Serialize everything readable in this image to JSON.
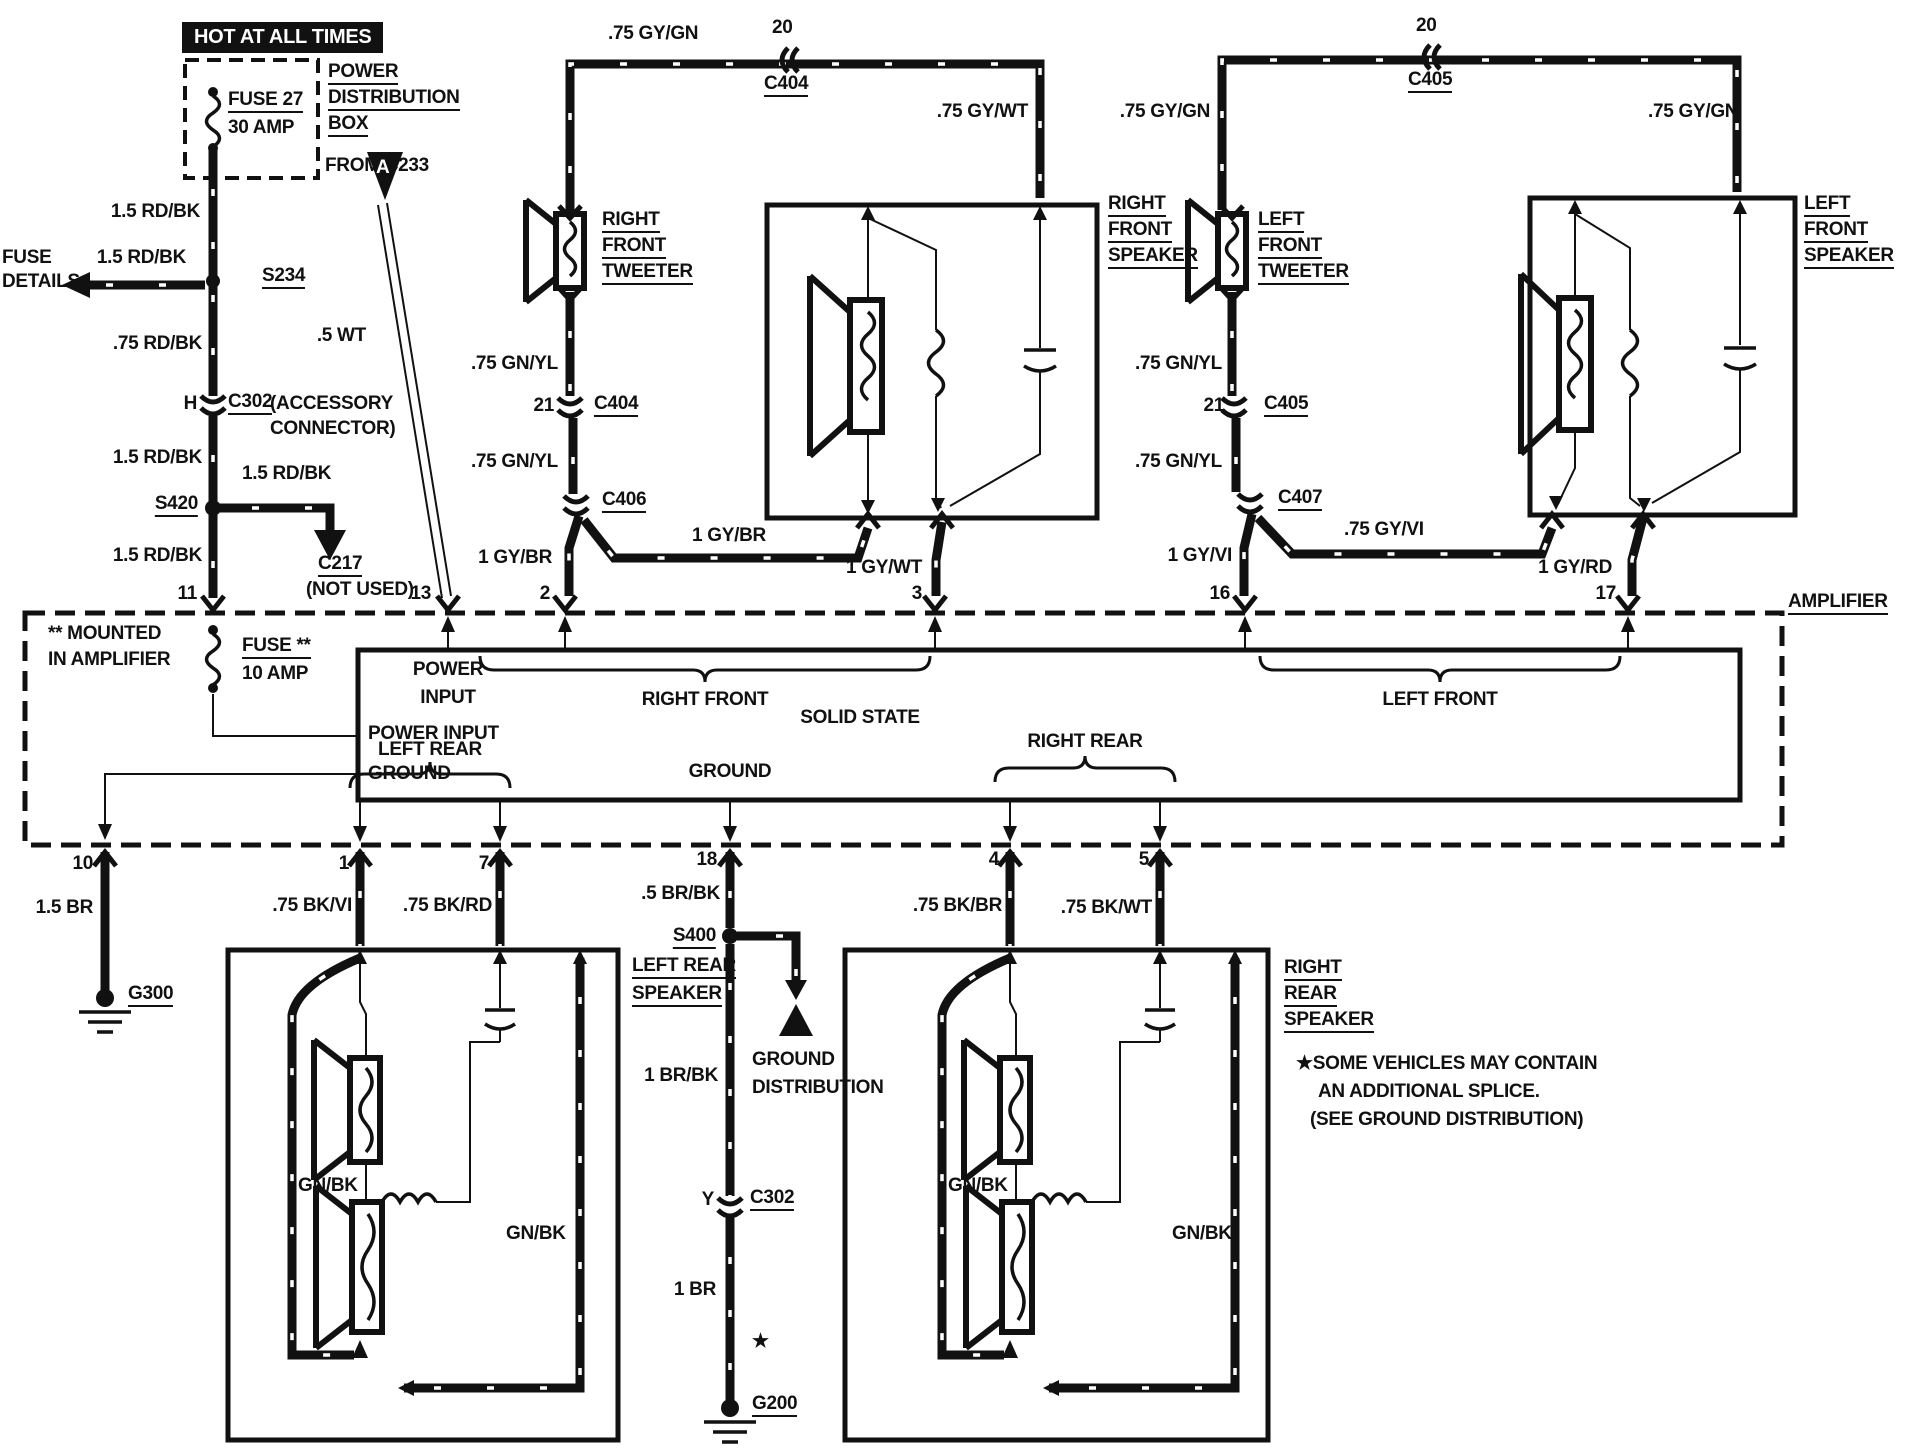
{
  "diagram": {
    "kind": "automotive audio system wiring diagram",
    "main_block": "AMPLIFIER (SOLID STATE)",
    "ink_color": "#111111",
    "paper_color": "#ffffff"
  },
  "components": [
    {
      "id": "FUSE 27",
      "rating": "30 AMP",
      "location": "POWER DISTRIBUTION BOX"
    },
    {
      "id": "FUSE **",
      "rating": "10 AMP",
      "location": "MOUNTED IN AMPLIFIER"
    },
    {
      "id": "AMPLIFIER",
      "note": "SOLID STATE"
    },
    {
      "id": "RIGHT FRONT TWEETER"
    },
    {
      "id": "RIGHT FRONT SPEAKER"
    },
    {
      "id": "LEFT FRONT TWEETER"
    },
    {
      "id": "LEFT FRONT SPEAKER"
    },
    {
      "id": "LEFT REAR SPEAKER"
    },
    {
      "id": "RIGHT REAR SPEAKER"
    },
    {
      "id": "S234"
    },
    {
      "id": "S420"
    },
    {
      "id": "S400"
    },
    {
      "id": "G200"
    },
    {
      "id": "G300"
    },
    {
      "id": "C217",
      "note": "NOT USED"
    },
    {
      "id": "C302",
      "note": "ACCESSORY CONNECTOR"
    },
    {
      "id": "C404"
    },
    {
      "id": "C405"
    },
    {
      "id": "C406"
    },
    {
      "id": "C407"
    }
  ],
  "labels": [
    {
      "name": "hot-at-all-times",
      "text": "HOT AT ALL TIMES",
      "x": 182,
      "y": 22,
      "inv": true
    },
    {
      "name": "fuse27",
      "text": "FUSE 27",
      "x": 228,
      "y": 90,
      "u": true
    },
    {
      "name": "fuse27-rating",
      "text": "30 AMP",
      "x": 228,
      "y": 118
    },
    {
      "name": "power-dist-1",
      "text": "POWER",
      "x": 328,
      "y": 62,
      "u": true
    },
    {
      "name": "power-dist-2",
      "text": "DISTRIBUTION",
      "x": 328,
      "y": 88,
      "u": true
    },
    {
      "name": "power-dist-3",
      "text": "BOX",
      "x": 328,
      "y": 114,
      "u": true
    },
    {
      "name": "from-c233",
      "text": "FROM C233",
      "x": 325,
      "y": 156
    },
    {
      "name": "wire-15rdbk-1",
      "text": "1.5 RD/BK",
      "x": 200,
      "y": 202,
      "align": "right"
    },
    {
      "name": "fuse-details-1",
      "text": "FUSE",
      "x": 2,
      "y": 248
    },
    {
      "name": "fuse-details-2",
      "text": "DETAILS",
      "x": 2,
      "y": 272
    },
    {
      "name": "wire-15rdbk-2",
      "text": "1.5 RD/BK",
      "x": 186,
      "y": 248,
      "align": "right"
    },
    {
      "name": "splice-s234",
      "text": "S234",
      "x": 262,
      "y": 266,
      "u": true
    },
    {
      "name": "wire-75rdbk",
      "text": ".75 RD/BK",
      "x": 202,
      "y": 334,
      "align": "right"
    },
    {
      "name": "c302-pin-h",
      "text": "H",
      "x": 197,
      "y": 394,
      "align": "right"
    },
    {
      "name": "conn-c302",
      "text": "C302",
      "x": 228,
      "y": 392,
      "u": true
    },
    {
      "name": "accessory-1",
      "text": "(ACCESSORY",
      "x": 270,
      "y": 394
    },
    {
      "name": "accessory-2",
      "text": "CONNECTOR)",
      "x": 270,
      "y": 419
    },
    {
      "name": "wire-15rdbk-3",
      "text": "1.5 RD/BK",
      "x": 202,
      "y": 448,
      "align": "right"
    },
    {
      "name": "splice-s420",
      "text": "S420",
      "x": 198,
      "y": 494,
      "u": true,
      "align": "right"
    },
    {
      "name": "wire-15rdbk-4",
      "text": "1.5 RD/BK",
      "x": 242,
      "y": 464
    },
    {
      "name": "conn-c217",
      "text": "C217",
      "x": 318,
      "y": 554,
      "u": true
    },
    {
      "name": "c217-not-used",
      "text": "(NOT USED)",
      "x": 306,
      "y": 580
    },
    {
      "name": "wire-15rdbk-5",
      "text": "1.5 RD/BK",
      "x": 202,
      "y": 546,
      "align": "right"
    },
    {
      "name": "pin-11",
      "text": "11",
      "x": 197,
      "y": 584,
      "align": "right"
    },
    {
      "name": "wire-5wt",
      "text": ".5 WT",
      "x": 366,
      "y": 326,
      "align": "right"
    },
    {
      "name": "pin-13",
      "text": "13",
      "x": 431,
      "y": 584,
      "align": "right"
    },
    {
      "name": "wire-gygn-1",
      "text": ".75 GY/GN",
      "x": 608,
      "y": 24
    },
    {
      "name": "c404-top-pin",
      "text": "20",
      "x": 772,
      "y": 18
    },
    {
      "name": "conn-c404-top",
      "text": "C404",
      "x": 764,
      "y": 74,
      "u": true
    },
    {
      "name": "wire-gywt-1",
      "text": ".75 GY/WT",
      "x": 1028,
      "y": 102,
      "align": "right"
    },
    {
      "name": "rf-tweeter-1",
      "text": "RIGHT",
      "x": 602,
      "y": 210,
      "u": true
    },
    {
      "name": "rf-tweeter-2",
      "text": "FRONT",
      "x": 602,
      "y": 236,
      "u": true
    },
    {
      "name": "rf-tweeter-3",
      "text": "TWEETER",
      "x": 602,
      "y": 262,
      "u": true
    },
    {
      "name": "wire-gnyl-1",
      "text": ".75 GN/YL",
      "x": 558,
      "y": 354,
      "align": "right"
    },
    {
      "name": "c404-pin-21",
      "text": "21",
      "x": 554,
      "y": 396,
      "align": "right"
    },
    {
      "name": "conn-c404",
      "text": "C404",
      "x": 594,
      "y": 394,
      "u": true
    },
    {
      "name": "wire-gnyl-2",
      "text": ".75 GN/YL",
      "x": 558,
      "y": 452,
      "align": "right"
    },
    {
      "name": "conn-c406",
      "text": "C406",
      "x": 602,
      "y": 490,
      "u": true
    },
    {
      "name": "wire-gybr-1",
      "text": "1 GY/BR",
      "x": 552,
      "y": 548,
      "align": "right"
    },
    {
      "name": "wire-gybr-2",
      "text": "1 GY/BR",
      "x": 692,
      "y": 526
    },
    {
      "name": "pin-2",
      "text": "2",
      "x": 550,
      "y": 584,
      "align": "right"
    },
    {
      "name": "wire-gywt-2",
      "text": "1 GY/WT",
      "x": 922,
      "y": 558,
      "align": "right"
    },
    {
      "name": "pin-3",
      "text": "3",
      "x": 922,
      "y": 584,
      "align": "right"
    },
    {
      "name": "rf-speaker-1",
      "text": "RIGHT",
      "x": 1108,
      "y": 194,
      "u": true
    },
    {
      "name": "rf-speaker-2",
      "text": "FRONT",
      "x": 1108,
      "y": 220,
      "u": true
    },
    {
      "name": "rf-speaker-3",
      "text": "SPEAKER",
      "x": 1108,
      "y": 246,
      "u": true
    },
    {
      "name": "wire-gygn-2",
      "text": ".75 GY/GN",
      "x": 1210,
      "y": 102,
      "align": "right"
    },
    {
      "name": "c405-top-pin",
      "text": "20",
      "x": 1416,
      "y": 16
    },
    {
      "name": "conn-c405-top",
      "text": "C405",
      "x": 1408,
      "y": 70,
      "u": true
    },
    {
      "name": "wire-gygn-3",
      "text": ".75 GY/GN",
      "x": 1648,
      "y": 102
    },
    {
      "name": "lf-tweeter-1",
      "text": "LEFT",
      "x": 1258,
      "y": 210,
      "u": true
    },
    {
      "name": "lf-tweeter-2",
      "text": "FRONT",
      "x": 1258,
      "y": 236,
      "u": true
    },
    {
      "name": "lf-tweeter-3",
      "text": "TWEETER",
      "x": 1258,
      "y": 262,
      "u": true
    },
    {
      "name": "wire-gnyl-3",
      "text": ".75 GN/YL",
      "x": 1222,
      "y": 354,
      "align": "right"
    },
    {
      "name": "c405-pin-21",
      "text": "21",
      "x": 1224,
      "y": 396,
      "align": "right"
    },
    {
      "name": "conn-c405",
      "text": "C405",
      "x": 1264,
      "y": 394,
      "u": true
    },
    {
      "name": "wire-gnyl-4",
      "text": ".75 GN/YL",
      "x": 1222,
      "y": 452,
      "align": "right"
    },
    {
      "name": "conn-c407",
      "text": "C407",
      "x": 1278,
      "y": 488,
      "u": true
    },
    {
      "name": "wire-gyvi-1",
      "text": "1 GY/VI",
      "x": 1232,
      "y": 546,
      "align": "right"
    },
    {
      "name": "wire-gyvi-2",
      "text": ".75 GY/VI",
      "x": 1344,
      "y": 520
    },
    {
      "name": "pin-16",
      "text": "16",
      "x": 1230,
      "y": 584,
      "align": "right"
    },
    {
      "name": "wire-gyrd",
      "text": "1 GY/RD",
      "x": 1612,
      "y": 558,
      "align": "right"
    },
    {
      "name": "pin-17",
      "text": "17",
      "x": 1616,
      "y": 584,
      "align": "right"
    },
    {
      "name": "lf-speaker-1",
      "text": "LEFT",
      "x": 1804,
      "y": 194,
      "u": true
    },
    {
      "name": "lf-speaker-2",
      "text": "FRONT",
      "x": 1804,
      "y": 220,
      "u": true
    },
    {
      "name": "lf-speaker-3",
      "text": "SPEAKER",
      "x": 1804,
      "y": 246,
      "u": true
    },
    {
      "name": "amplifier",
      "text": "AMPLIFIER",
      "x": 1788,
      "y": 592,
      "u": true
    },
    {
      "name": "mounted-1",
      "text": "** MOUNTED",
      "x": 48,
      "y": 624
    },
    {
      "name": "mounted-2",
      "text": "IN AMPLIFIER",
      "x": 48,
      "y": 650
    },
    {
      "name": "fuse-amp",
      "text": "FUSE **",
      "x": 242,
      "y": 636,
      "u": true
    },
    {
      "name": "fuse-amp-rating",
      "text": "10 AMP",
      "x": 242,
      "y": 664
    },
    {
      "name": "power-input13-1",
      "text": "POWER",
      "x": 448,
      "y": 660,
      "align": "center"
    },
    {
      "name": "power-input13-2",
      "text": "INPUT",
      "x": 448,
      "y": 688,
      "align": "center"
    },
    {
      "name": "brace-right-front",
      "text": "RIGHT FRONT",
      "x": 705,
      "y": 690,
      "align": "center"
    },
    {
      "name": "solid-state",
      "text": "SOLID STATE",
      "x": 860,
      "y": 708,
      "align": "center"
    },
    {
      "name": "brace-left-front",
      "text": "LEFT FRONT",
      "x": 1440,
      "y": 690,
      "align": "center"
    },
    {
      "name": "power-input-left",
      "text": "POWER INPUT",
      "x": 368,
      "y": 724
    },
    {
      "name": "ground-left",
      "text": "GROUND",
      "x": 368,
      "y": 764
    },
    {
      "name": "brace-left-rear",
      "text": "LEFT REAR",
      "x": 430,
      "y": 740,
      "align": "center"
    },
    {
      "name": "ground-center",
      "text": "GROUND",
      "x": 730,
      "y": 762,
      "align": "center"
    },
    {
      "name": "brace-right-rear",
      "text": "RIGHT REAR",
      "x": 1085,
      "y": 732,
      "align": "center"
    },
    {
      "name": "pin-10",
      "text": "10",
      "x": 93,
      "y": 854,
      "align": "right"
    },
    {
      "name": "wire-15br",
      "text": "1.5 BR",
      "x": 93,
      "y": 898,
      "align": "right"
    },
    {
      "name": "ground-g300",
      "text": "G300",
      "x": 128,
      "y": 984,
      "u": true
    },
    {
      "name": "pin-1",
      "text": "1",
      "x": 349,
      "y": 854,
      "align": "right"
    },
    {
      "name": "wire-bkvi",
      "text": ".75 BK/VI",
      "x": 352,
      "y": 896,
      "align": "right"
    },
    {
      "name": "pin-7",
      "text": "7",
      "x": 489,
      "y": 854,
      "align": "right"
    },
    {
      "name": "wire-bkrd",
      "text": ".75 BK/RD",
      "x": 492,
      "y": 896,
      "align": "right"
    },
    {
      "name": "pin-18",
      "text": "18",
      "x": 717,
      "y": 850,
      "align": "right"
    },
    {
      "name": "wire-brbk",
      "text": ".5 BR/BK",
      "x": 720,
      "y": 884,
      "align": "right"
    },
    {
      "name": "splice-s400",
      "text": "S400",
      "x": 716,
      "y": 926,
      "u": true,
      "align": "right"
    },
    {
      "name": "pin-4",
      "text": "4",
      "x": 999,
      "y": 850,
      "align": "right"
    },
    {
      "name": "wire-bkbr",
      "text": ".75 BK/BR",
      "x": 1002,
      "y": 896,
      "align": "right"
    },
    {
      "name": "pin-5",
      "text": "5",
      "x": 1149,
      "y": 850,
      "align": "right"
    },
    {
      "name": "wire-bkwt",
      "text": ".75 BK/WT",
      "x": 1152,
      "y": 898,
      "align": "right"
    },
    {
      "name": "lr-speaker-1",
      "text": "LEFT REAR",
      "x": 632,
      "y": 956,
      "u": true
    },
    {
      "name": "lr-speaker-2",
      "text": "SPEAKER",
      "x": 632,
      "y": 984,
      "u": true
    },
    {
      "name": "ground-dist-1",
      "text": "GROUND",
      "x": 752,
      "y": 1050
    },
    {
      "name": "ground-dist-2",
      "text": "DISTRIBUTION",
      "x": 752,
      "y": 1078
    },
    {
      "name": "wire-brbk-2",
      "text": "1 BR/BK",
      "x": 718,
      "y": 1066,
      "align": "right"
    },
    {
      "name": "c302y-pin",
      "text": "Y",
      "x": 714,
      "y": 1190,
      "align": "right"
    },
    {
      "name": "conn-c302-y",
      "text": "C302",
      "x": 750,
      "y": 1188,
      "u": true
    },
    {
      "name": "wire-1br",
      "text": "1 BR",
      "x": 716,
      "y": 1280,
      "align": "right"
    },
    {
      "name": "splice-star",
      "text": "★",
      "x": 752,
      "y": 1332
    },
    {
      "name": "ground-g200",
      "text": "G200",
      "x": 752,
      "y": 1394,
      "u": true
    },
    {
      "name": "rr-speaker-1",
      "text": "RIGHT",
      "x": 1284,
      "y": 958,
      "u": true
    },
    {
      "name": "rr-speaker-2",
      "text": "REAR",
      "x": 1284,
      "y": 984,
      "u": true
    },
    {
      "name": "rr-speaker-3",
      "text": "SPEAKER",
      "x": 1284,
      "y": 1010,
      "u": true
    },
    {
      "name": "note-1",
      "text": "★SOME VEHICLES MAY CONTAIN",
      "x": 1296,
      "y": 1054
    },
    {
      "name": "note-2",
      "text": "AN ADDITIONAL SPLICE.",
      "x": 1318,
      "y": 1082
    },
    {
      "name": "note-3",
      "text": "(SEE GROUND DISTRIBUTION)",
      "x": 1310,
      "y": 1110
    },
    {
      "name": "wire-gnbk-ll",
      "text": "GN/BK",
      "x": 298,
      "y": 1176
    },
    {
      "name": "wire-gnbk-lr",
      "text": "GN/BK",
      "x": 506,
      "y": 1224
    },
    {
      "name": "wire-gnbk-rl",
      "text": "GN/BK",
      "x": 948,
      "y": 1176
    },
    {
      "name": "wire-gnbk-rr",
      "text": "GN/BK",
      "x": 1172,
      "y": 1224
    },
    {
      "name": "triangle-a-letter",
      "text": "A",
      "x": 376,
      "y": 158,
      "white": true
    }
  ]
}
